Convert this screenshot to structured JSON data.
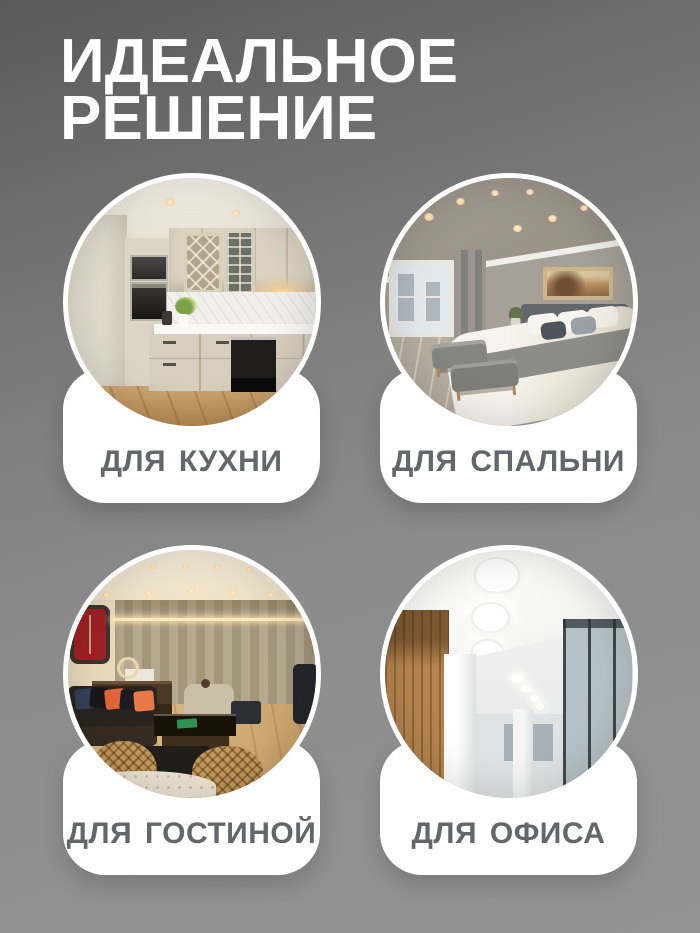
{
  "title": {
    "line1": "ИДЕАЛЬНОЕ",
    "line2": "РЕШЕНИЕ"
  },
  "cards": [
    {
      "id": "kitchen",
      "label": "ДЛЯ КУХНИ",
      "photo_alt": "kitchen with beige cabinets, built-in ovens and recessed ceiling lights"
    },
    {
      "id": "bedroom",
      "label": "ДЛЯ СПАЛЬНИ",
      "photo_alt": "bedroom with dropped ceiling, recessed spotlights, bed and window"
    },
    {
      "id": "living-room",
      "label": "ДЛЯ ГОСТИНОЙ",
      "photo_alt": "living room with warm recessed lights, dark sofa with orange pillows and curtains"
    },
    {
      "id": "office",
      "label": "ДЛЯ ОФИСА",
      "photo_alt": "office ceiling with large round recessed LED lights"
    }
  ],
  "colors": {
    "background_top": "#595959",
    "background_bottom": "#939393",
    "title_text": "#ffffff",
    "plate": "#ffffff",
    "label_text": "#646669"
  }
}
